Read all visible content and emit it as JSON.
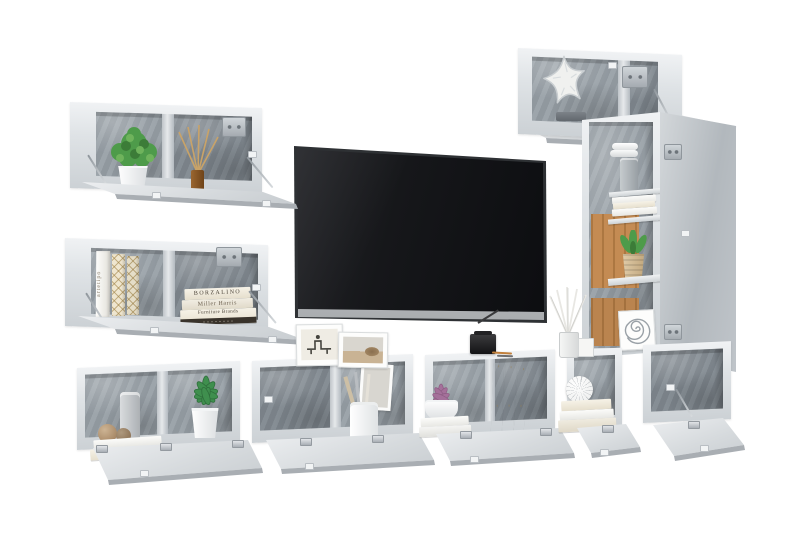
{
  "image": {
    "type": "product-photo",
    "subject": "wall-mounted TV furniture set in concrete grey with open flap doors, flat-screen TV and decor",
    "background": "#ffffff"
  },
  "palette": {
    "panel_light": "#e6e9ec",
    "panel_mid": "#cfd4d8",
    "concrete_back": "#98a0a7",
    "concrete_dark": "#80888f",
    "wood_back": "#c08448",
    "tv_screen": "#101114",
    "tv_strip": "#c6c9cc",
    "plant_green": "#4e9b4a",
    "succulent_green": "#3f8f4e",
    "flower_purple": "#a4709a",
    "book_cream": "#efe8d8",
    "amber_bottle": "#8a5a28",
    "metal": "#b3b9be",
    "starfish_white": "#f0f1ef"
  },
  "books": {
    "upright_spine_text": "artetipo",
    "stacked_titles": [
      "BORZALINO",
      "Miller Harris",
      "Furniture Brands"
    ]
  },
  "units": [
    "top-left-wall-box",
    "mid-left-wall-box",
    "top-right-wall-box",
    "tall-display-cabinet",
    "bench-box-1",
    "bench-box-2",
    "bench-box-3",
    "bench-box-4",
    "bench-box-5",
    "flat-screen-tv"
  ],
  "decor_items": [
    "potted-plant",
    "reed-diffuser",
    "design-books",
    "starfish",
    "succulent",
    "cylinder-vase",
    "yarn-balls",
    "pencil-cup",
    "flower-bowl",
    "openwork-sphere",
    "book-stacks",
    "picture-frames",
    "mini-black-lantern",
    "white-reed-diffuser",
    "woven-pot-plant",
    "spiral-artwork",
    "grey-jar",
    "towel-rolls"
  ]
}
